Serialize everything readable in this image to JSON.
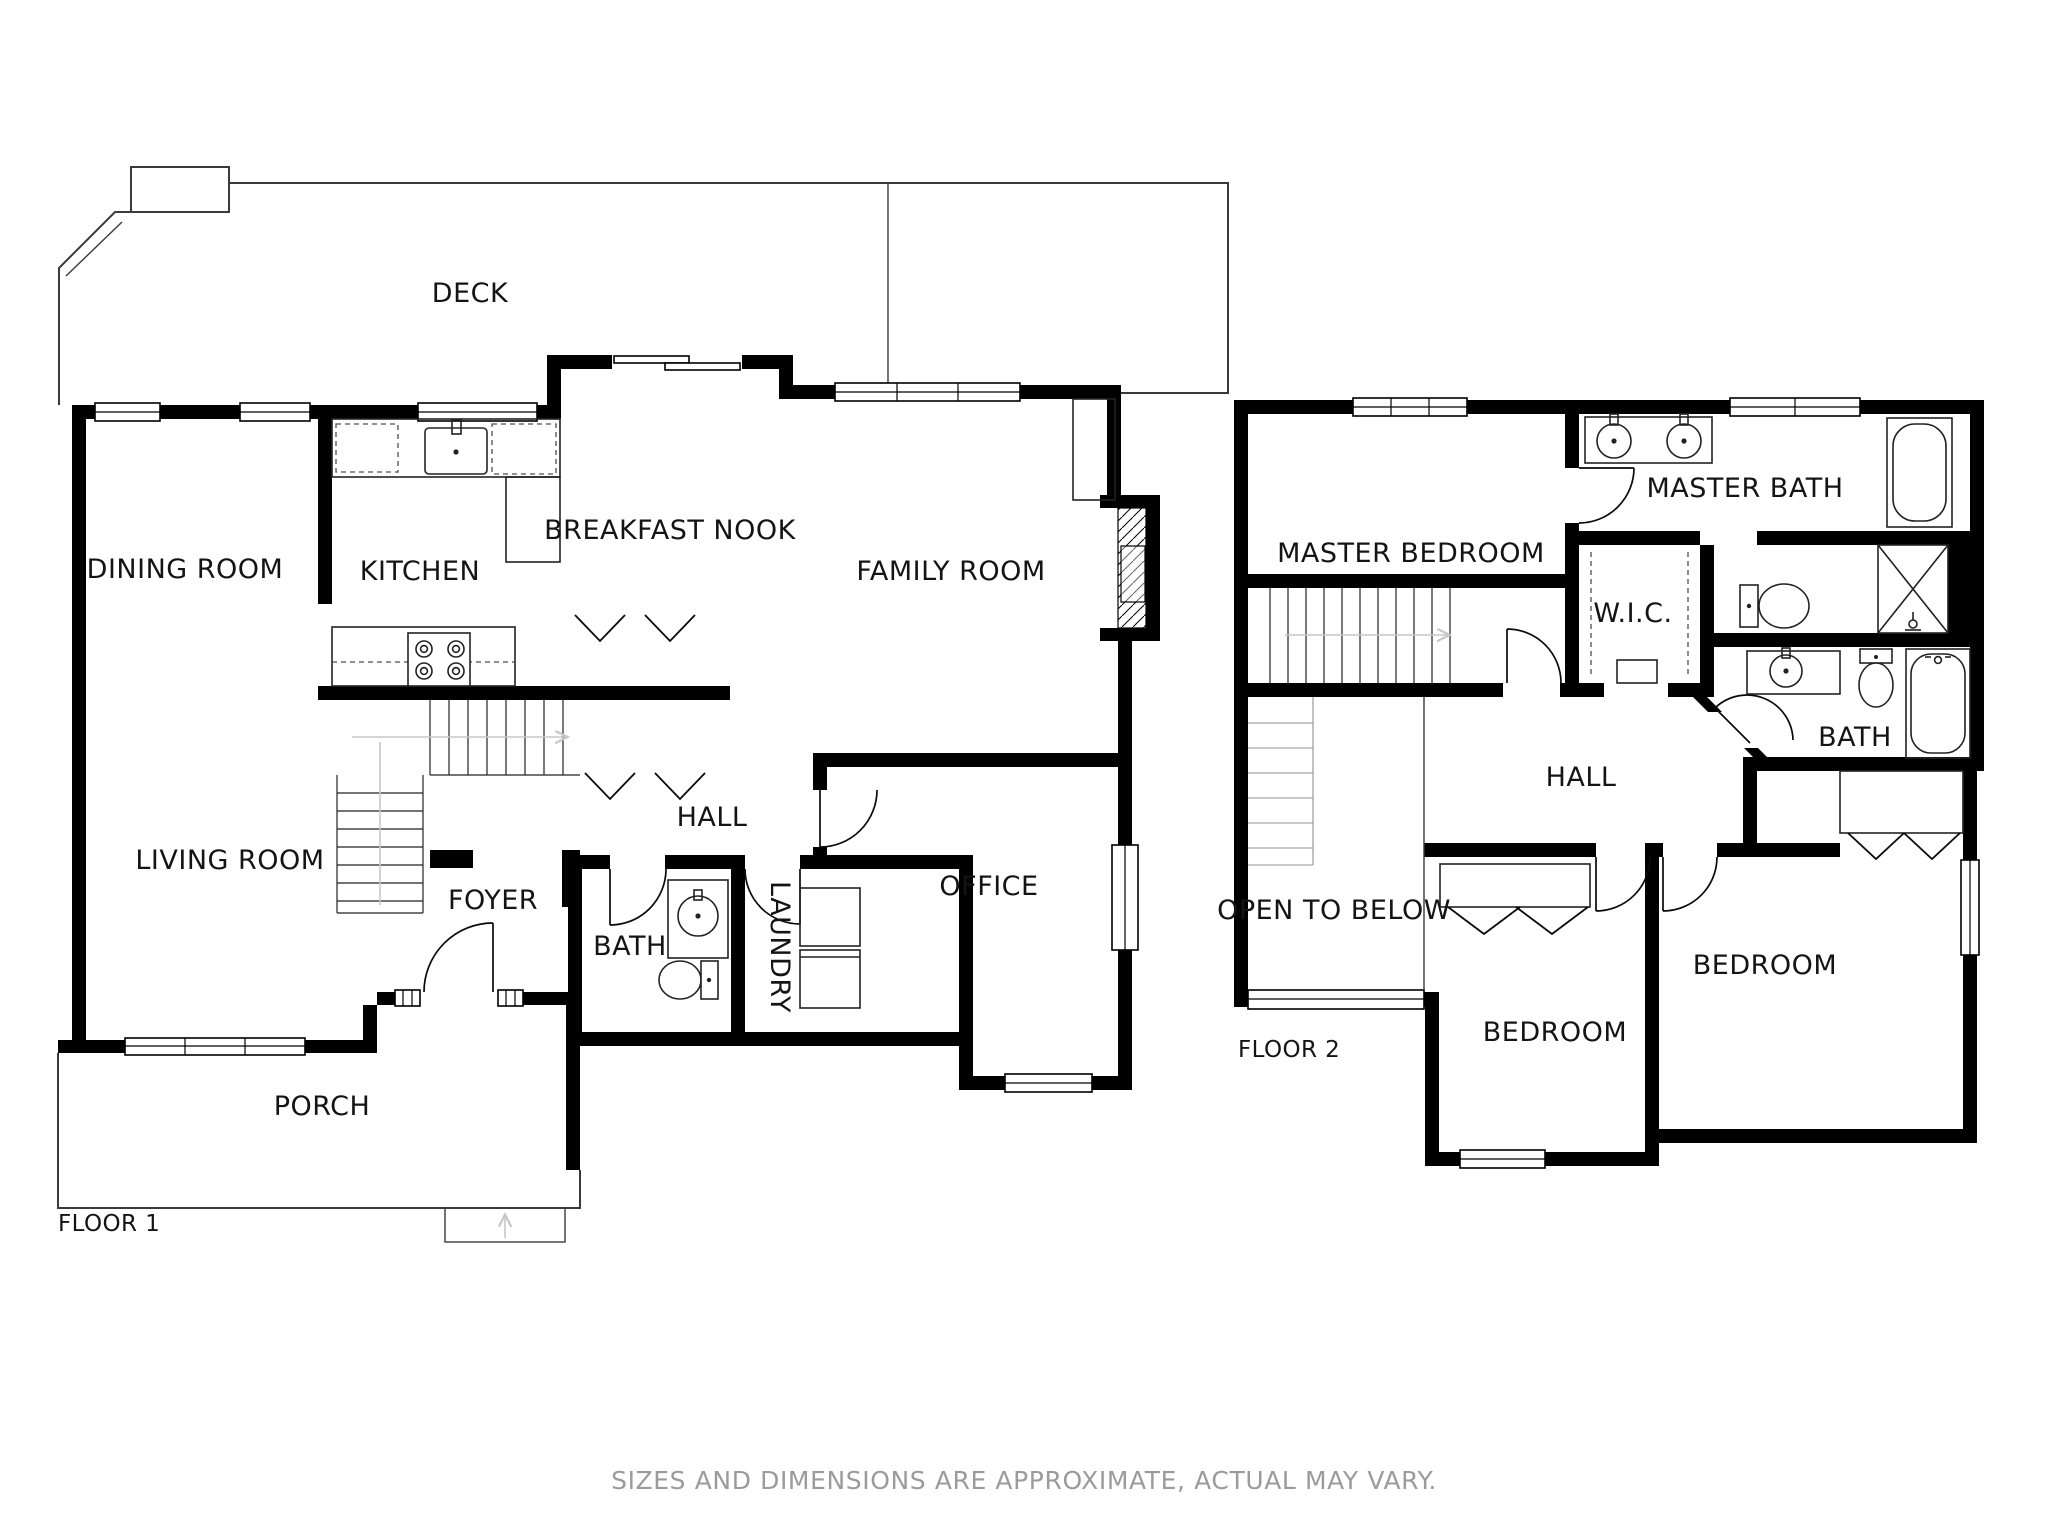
{
  "meta": {
    "type": "floor-plan",
    "floors": 2
  },
  "floor1": {
    "name": "FLOOR 1",
    "rooms": {
      "deck": "DECK",
      "dining": "DINING ROOM",
      "kitchen": "KITCHEN",
      "nook": "BREAKFAST NOOK",
      "family": "FAMILY ROOM",
      "living": "LIVING ROOM",
      "foyer": "FOYER",
      "bath": "BATH",
      "laundry": "LAUNDRY",
      "hall": "HALL",
      "office": "OFFICE",
      "porch": "PORCH"
    }
  },
  "floor2": {
    "name": "FLOOR 2",
    "rooms": {
      "master_bedroom": "MASTER BEDROOM",
      "master_bath": "MASTER BATH",
      "wic": "W.I.C.",
      "bath": "BATH",
      "hall": "HALL",
      "open_below": "OPEN TO BELOW",
      "bedroom_mid": "BEDROOM",
      "bedroom_right": "BEDROOM"
    }
  },
  "footer": {
    "disclaimer": "SIZES AND DIMENSIONS ARE APPROXIMATE, ACTUAL MAY VARY."
  },
  "colors": {
    "wall": "#000000",
    "label": "#141414",
    "muted": "#9b9b9b",
    "thin_line": "#3a3a3a"
  }
}
